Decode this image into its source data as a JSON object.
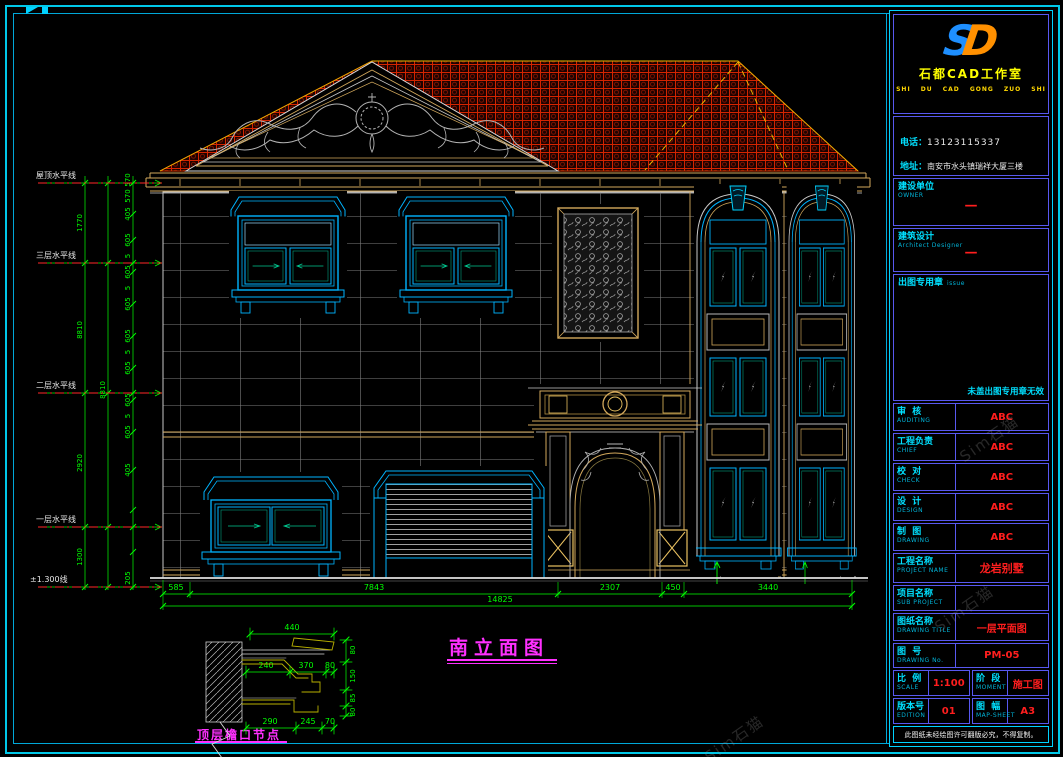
{
  "sheet": {
    "watermark": "Sim石猫"
  },
  "title_block": {
    "logo": {
      "s": "S",
      "d": "D",
      "company": "石都CAD工作室",
      "pinyin": "SHI DU CAD GONG ZUO SHI"
    },
    "contact": {
      "phone_label": "电话：",
      "phone": "13123115337",
      "address_label": "地址：",
      "address": "南安市水头镇瑞祥大厦三楼"
    },
    "owner": {
      "label_cn": "建设单位",
      "label_en": "OWNER",
      "value": "—"
    },
    "designer": {
      "label_cn": "建筑设计",
      "label_en": "Architect Designer",
      "value": "—"
    },
    "seal": {
      "label_cn": "出图专用章",
      "label_en": "issue",
      "note": "未盖出图专用章无效"
    },
    "rows": [
      {
        "cn": "审  核",
        "en": "AUDITING",
        "value": "ABC"
      },
      {
        "cn": "工程负责",
        "en": "CHIEF",
        "value": "ABC"
      },
      {
        "cn": "校  对",
        "en": "CHECK",
        "value": "ABC"
      },
      {
        "cn": "设  计",
        "en": "DESIGN",
        "value": "ABC"
      },
      {
        "cn": "制  图",
        "en": "DRAWING",
        "value": "ABC"
      }
    ],
    "project": {
      "cn": "工程名称",
      "en": "PROJECT NAME",
      "value": "龙岩别墅"
    },
    "sub_project": {
      "cn": "项目名称",
      "en": "SUB PROJECT",
      "value": ""
    },
    "drawing_title": {
      "cn": "图纸名称",
      "en": "DRAWING TITLE",
      "value": "一层平面图"
    },
    "drawing_no": {
      "cn": "图  号",
      "en": "DRAWING No.",
      "value": "PM-05"
    },
    "scale": {
      "cn": "比  例",
      "en": "SCALE",
      "value": "1:100"
    },
    "stage": {
      "cn": "阶  段",
      "en": "MOMENT",
      "value": "施工图"
    },
    "edition": {
      "cn": "版本号",
      "en": "EDITION",
      "value": "01"
    },
    "map_sheet": {
      "cn": "图  幅",
      "en": "MAP-SHEET",
      "value": "A3"
    },
    "note": "此图纸未经绘图许可翻版必究，不得复制。"
  },
  "elevation": {
    "title": "南立面图",
    "levels": [
      "屋顶水平线",
      "三层水平线",
      "二层水平线",
      "一层水平线",
      "±1.300线"
    ],
    "dims_bottom": [
      "585",
      "7843",
      "2307",
      "450",
      "3440"
    ],
    "dim_total": "14825",
    "dims_left_a": [
      "1770",
      "8810",
      "2920",
      "1300"
    ],
    "dims_left_b": [
      "8810"
    ],
    "dims_left_c": [
      "570",
      "570",
      "405",
      "605",
      "5",
      "605",
      "5",
      "605",
      "605",
      "5",
      "605",
      "605",
      "5",
      "605",
      "405",
      "205"
    ]
  },
  "detail": {
    "title": "顶层檐口节点",
    "dims_top": [
      "440"
    ],
    "dims_mid": [
      "240",
      "370",
      "80"
    ],
    "dims_bottom": [
      "290",
      "245",
      "70"
    ],
    "dims_right": [
      "80",
      "150",
      "85",
      "80"
    ]
  }
}
